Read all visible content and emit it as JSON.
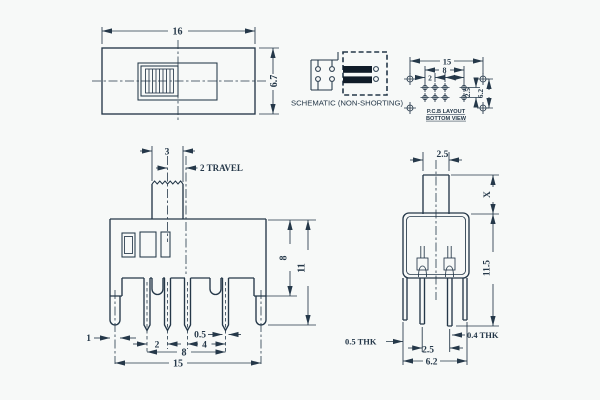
{
  "colors": {
    "line": "#253849",
    "background": "#f7f9f8",
    "contact_bar": "#101c28"
  },
  "views": {
    "top": {
      "dim_width": "16",
      "dim_height": "6.7"
    },
    "schematic": {
      "label": "SCHEMATIC (NON-SHORTING)"
    },
    "pcb": {
      "dim_overall": "15",
      "dim_pin_span": "8",
      "dim_pitch_a": "2",
      "dim_pitch_b": "4",
      "dim_row_pitch": "2.5",
      "dim_mount_span": "6.2",
      "caption_line1": "P.C.B LAYOUT",
      "caption_line2": "BOTTOM VIEW"
    },
    "front": {
      "dim_knob_width": "3",
      "dim_travel": "2 TRAVEL",
      "dim_body_height": "8",
      "dim_total_height": "11",
      "dim_leg_width": "1",
      "dim_pitch_a": "2",
      "dim_pin_width": "0.5",
      "dim_pitch_b": "4",
      "dim_pin_span": "8",
      "dim_overall": "15"
    },
    "side": {
      "dim_stem_width": "2.5",
      "dim_stem_height": "X",
      "dim_total_height": "11.5",
      "dim_leg_thickness": "0.5 THK",
      "dim_pin_thickness": "0.4 THK",
      "dim_row_pitch": "2.5",
      "dim_depth": "6.2"
    }
  }
}
